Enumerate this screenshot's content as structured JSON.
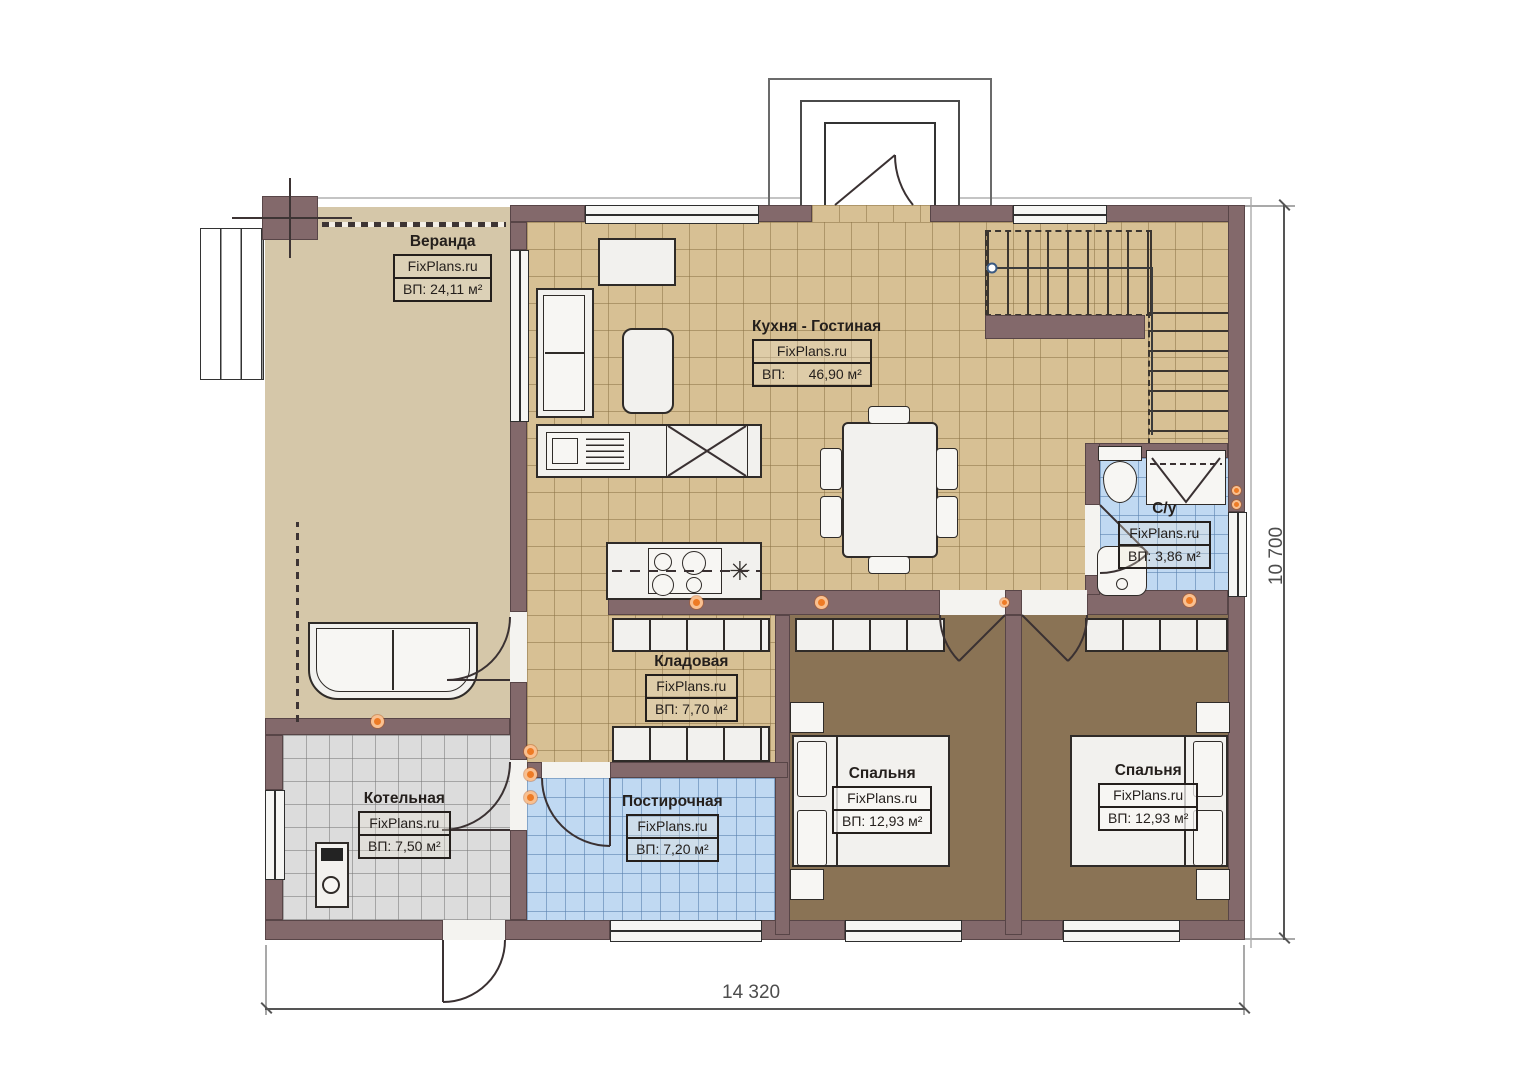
{
  "watermark": "FixPlans.ru",
  "rooms": [
    {
      "key": "veranda",
      "name": "Веранда",
      "brand": "FixPlans.ru",
      "area": "ВП: 24,11 м²"
    },
    {
      "key": "kitchen_living",
      "name": "Кухня - Гостиная",
      "brand": "FixPlans.ru",
      "area": "ВП:      46,90 м²"
    },
    {
      "key": "bathroom",
      "name": "С/у",
      "brand": "FixPlans.ru",
      "area": "ВП: 3,86 м²"
    },
    {
      "key": "storage",
      "name": "Кладовая",
      "brand": "FixPlans.ru",
      "area": "ВП: 7,70 м²"
    },
    {
      "key": "boiler",
      "name": "Котельная",
      "brand": "FixPlans.ru",
      "area": "ВП: 7,50 м²"
    },
    {
      "key": "laundry",
      "name": "Постирочная",
      "brand": "FixPlans.ru",
      "area": "ВП: 7,20 м²"
    },
    {
      "key": "bedroom1",
      "name": "Спальня",
      "brand": "FixPlans.ru",
      "area": "ВП: 12,93 м²"
    },
    {
      "key": "bedroom2",
      "name": "Спальня",
      "brand": "FixPlans.ru",
      "area": "ВП: 12,93 м²"
    }
  ],
  "dimensions": {
    "width_mm": "14 320",
    "height_mm": "10 700"
  },
  "icons": {
    "snowflake": "✳"
  },
  "colors": {
    "wall": "#83696b",
    "floor_tan": "#d5c7a9",
    "floor_tan_grid": "#d7c094",
    "floor_brown": "#8a7355",
    "floor_blue": "#c0d9f2",
    "floor_gray": "#dcdcdc",
    "accent_orange": "#ee7b25"
  }
}
